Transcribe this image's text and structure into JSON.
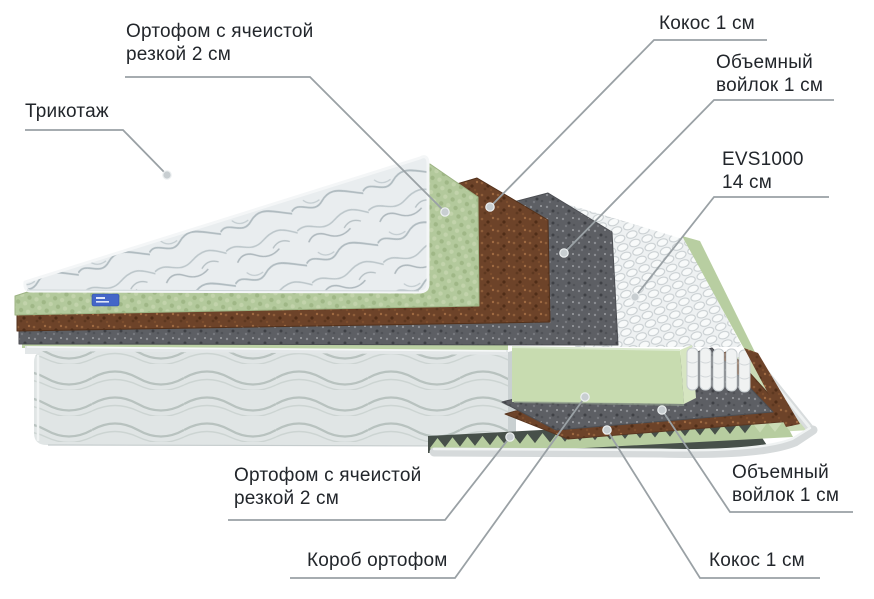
{
  "diagram": {
    "type": "mattress-layers-cutaway",
    "labels": {
      "trikotazh": {
        "text": "Трикотаж"
      },
      "ortofoam_top": {
        "line1": "Ортофом с ячеистой",
        "line2": "резкой 2 см"
      },
      "kokos_top": {
        "text": "Кокос 1 см"
      },
      "felt_top": {
        "line1": "Объемный",
        "line2": "войлок 1 см"
      },
      "evs": {
        "line1": "EVS1000",
        "line2": "14 см"
      },
      "ortofoam_bottom": {
        "line1": "Ортофом с ячеистой",
        "line2": "резкой 2 см"
      },
      "korob": {
        "text": "Короб ортофом"
      },
      "kokos_bottom": {
        "text": "Кокос 1 см"
      },
      "felt_bottom": {
        "line1": "Объемный",
        "line2": "войлок 1 см"
      }
    },
    "layers_top_to_bottom": [
      {
        "name": "Трикотаж"
      },
      {
        "name": "Ортофом с ячеистой резкой",
        "thickness": "2 см"
      },
      {
        "name": "Кокос",
        "thickness": "1 см"
      },
      {
        "name": "Объемный войлок",
        "thickness": "1 см"
      },
      {
        "name": "EVS1000",
        "thickness": "14 см"
      },
      {
        "name": "Объемный войлок",
        "thickness": "1 см"
      },
      {
        "name": "Кокос",
        "thickness": "1 см"
      },
      {
        "name": "Ортофом с ячеистой резкой",
        "thickness": "2 см"
      },
      {
        "name": "Короб ортофом"
      }
    ],
    "colors": {
      "text": "#22262b",
      "leader_line": "#9aa1a5",
      "eggcrate_green": "#b5ca9e",
      "foam_block_green": "#c8dcb0",
      "coconut_brown": "#6d4329",
      "felt_gray": "#5d5f64",
      "spring_white": "#eef1f2",
      "fabric_gray": "#e2e7e7",
      "tag_blue": "#4466c8",
      "background": "#ffffff"
    }
  }
}
